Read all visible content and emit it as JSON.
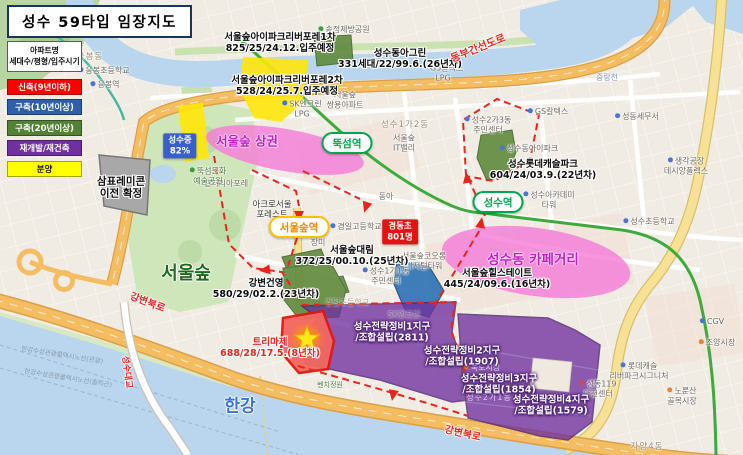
{
  "title": "성수 59타입 임장지도",
  "legend": {
    "header": [
      "아파트명",
      "세대수/평형/입주시기"
    ],
    "items": [
      {
        "label": "신축(9년이하)",
        "color": "#ff0000",
        "text": "#ffffff"
      },
      {
        "label": "구축(10년이상)",
        "color": "#2e5fa8",
        "text": "#ffffff"
      },
      {
        "label": "구축(20년이상)",
        "color": "#538135",
        "text": "#ffffff"
      },
      {
        "label": "재개발/재건축",
        "color": "#7030a0",
        "text": "#ffffff"
      },
      {
        "label": "분양",
        "color": "#ffff00",
        "text": "#1a1a1a"
      }
    ]
  },
  "stations": [
    {
      "id": "ttukseom-station",
      "name": "뚝섬역",
      "x": 347,
      "y": 143,
      "style": "green"
    },
    {
      "id": "seongsu-station",
      "name": "성수역",
      "x": 498,
      "y": 202,
      "style": "green"
    },
    {
      "id": "seoulsup-station",
      "name": "서울숲역",
      "x": 299,
      "y": 227,
      "style": "yellow"
    }
  ],
  "areas": [
    {
      "id": "seoulsup-commercial",
      "label": "서울숲 상권",
      "x": 247,
      "y": 140,
      "size": 12.5
    },
    {
      "id": "seongsu-cafe-street",
      "label": "성수동 카페거리",
      "x": 533,
      "y": 258,
      "size": 13.5
    }
  ],
  "badges": [
    {
      "id": "seongsu-middle-rate",
      "lines": [
        "성수중",
        "82%"
      ],
      "x": 180,
      "y": 146,
      "bg": "#3b5fc8"
    },
    {
      "id": "kyungdong-elem-size",
      "lines": [
        "경동초",
        "801명"
      ],
      "x": 400,
      "y": 232,
      "bg": "#e11414"
    }
  ],
  "apartments": [
    {
      "lines": [
        "서울숲아이파크리버포레1차",
        "825/25/24.12.입주예정"
      ],
      "x": 280,
      "y": 43,
      "cls": ""
    },
    {
      "lines": [
        "서울숲아이파크리버포레2차",
        "528/24/25.7.입주예정"
      ],
      "x": 287,
      "y": 86,
      "cls": ""
    },
    {
      "lines": [
        "성수동아그린",
        "331세대/22/99.6.(26년차)"
      ],
      "x": 400,
      "y": 59,
      "cls": ""
    },
    {
      "lines": [
        "성수롯데캐슬파크",
        "604/24/03.9.(22년차)"
      ],
      "x": 543,
      "y": 170,
      "cls": ""
    },
    {
      "lines": [
        "서울숲대림",
        "372/25/00.10.(25년차)"
      ],
      "x": 352,
      "y": 256,
      "cls": ""
    },
    {
      "lines": [
        "서울숲힐스테이트",
        "445/24/09.6.(16년차)"
      ],
      "x": 497,
      "y": 279,
      "cls": ""
    },
    {
      "lines": [
        "강변건영",
        "580/29/02.2.(23년차)"
      ],
      "x": 266,
      "y": 289,
      "cls": ""
    },
    {
      "lines": [
        "트리마제",
        "688/28/17.5.(8년차)"
      ],
      "x": 270,
      "y": 348,
      "cls": "red"
    },
    {
      "lines": [
        "삼표레미콘",
        "이전 확정"
      ],
      "x": 121,
      "y": 188,
      "cls": "big"
    }
  ],
  "zones": [
    {
      "lines": [
        "성수전략정비1지구",
        "/조합설립(2811)"
      ],
      "x": 392,
      "y": 333
    },
    {
      "lines": [
        "성수전략정비2지구",
        "/조합설립(1907)"
      ],
      "x": 462,
      "y": 357
    },
    {
      "lines": [
        "성수전략정비3지구",
        "/조합설립(1854)"
      ],
      "x": 499,
      "y": 385
    },
    {
      "lines": [
        "성수전략정비4지구",
        "/조합설립(1579)"
      ],
      "x": 551,
      "y": 406
    }
  ],
  "road_labels": [
    {
      "text": "동부간선도로",
      "x": 478,
      "y": 48,
      "rot": -22,
      "size": 10.5
    },
    {
      "text": "강변북로",
      "x": 148,
      "y": 301,
      "rot": 21,
      "size": 10
    },
    {
      "text": "강변북로",
      "x": 463,
      "y": 432,
      "rot": 13,
      "size": 10
    },
    {
      "text": "성수대교",
      "x": 128,
      "y": 372,
      "rot": 83,
      "size": 9
    }
  ],
  "big_labels": [
    {
      "text": "서울숲",
      "x": 186,
      "y": 272,
      "color": "#1e6b1e",
      "size": 18
    },
    {
      "text": "한강",
      "x": 240,
      "y": 404,
      "color": "#3a6fd8",
      "size": 17
    }
  ],
  "map_labels": [
    {
      "lines": [
        "응봉체육공원"
      ],
      "x": 167,
      "y": 32,
      "ico": "park"
    },
    {
      "lines": [
        "응봉동"
      ],
      "x": 90,
      "y": 57,
      "cls": "district"
    },
    {
      "lines": [
        "응봉초등학교"
      ],
      "x": 104,
      "y": 71,
      "ico": "school"
    },
    {
      "lines": [
        "응봉역"
      ],
      "x": 105,
      "y": 85,
      "ico": "rail"
    },
    {
      "lines": [
        "송정제방공원"
      ],
      "x": 344,
      "y": 30,
      "ico": "park"
    },
    {
      "lines": [
        "중랑천"
      ],
      "x": 607,
      "y": 78,
      "cls": "water"
    },
    {
      "lines": [
        "서울숲",
        "쌍용아파트"
      ],
      "x": 345,
      "y": 100
    },
    {
      "lines": [
        "SK엔크린",
        "LPG"
      ],
      "x": 302,
      "y": 109,
      "ico": "gas"
    },
    {
      "lines": [
        "GS칼텍스",
        "LPG"
      ],
      "x": 443,
      "y": 73,
      "ico": "gas"
    },
    {
      "lines": [
        "갤러리아포레"
      ],
      "x": 226,
      "y": 184
    },
    {
      "lines": [
        "뚝섬문화",
        "예술공원"
      ],
      "x": 208,
      "y": 176,
      "cls": "green",
      "ico": "park"
    },
    {
      "lines": [
        "성수1가2동"
      ],
      "x": 405,
      "y": 125,
      "cls": "district"
    },
    {
      "lines": [
        "서울숲",
        "IT밸리"
      ],
      "x": 404,
      "y": 143
    },
    {
      "lines": [
        "성수2가3동",
        "주민센터"
      ],
      "x": 488,
      "y": 125,
      "ico": "civic"
    },
    {
      "lines": [
        "성수동아이파크"
      ],
      "x": 529,
      "y": 149,
      "ico": "civic"
    },
    {
      "lines": [
        "GS칼텍스"
      ],
      "x": 548,
      "y": 112,
      "ico": "gas"
    },
    {
      "lines": [
        "성동세무서"
      ],
      "x": 637,
      "y": 117,
      "ico": "civic"
    },
    {
      "lines": [
        "생각공장",
        "데시앙플렉스"
      ],
      "x": 686,
      "y": 166,
      "ico": "civic"
    },
    {
      "lines": [
        "동아"
      ],
      "x": 386,
      "y": 197
    },
    {
      "lines": [
        "아크로서울",
        "포레스트"
      ],
      "x": 272,
      "y": 210,
      "cls": "strong"
    },
    {
      "lines": [
        "장미"
      ],
      "x": 318,
      "y": 243
    },
    {
      "lines": [
        "경일고등학교"
      ],
      "x": 356,
      "y": 227,
      "ico": "school"
    },
    {
      "lines": [
        "성수아카데미",
        "타워"
      ],
      "x": 549,
      "y": 200,
      "ico": "civic"
    },
    {
      "lines": [
        "성수초등학교"
      ],
      "x": 649,
      "y": 222,
      "ico": "school"
    },
    {
      "lines": [
        "서울숲코오롱",
        "디지털타워"
      ],
      "x": 424,
      "y": 261
    },
    {
      "lines": [
        "성수1가1동",
        "주민센터"
      ],
      "x": 386,
      "y": 276,
      "ico": "civic"
    },
    {
      "lines": [
        "경일초등학교"
      ],
      "x": 347,
      "y": 303,
      "cls": "dim"
    },
    {
      "lines": [
        "SK엔크린"
      ],
      "x": 404,
      "y": 315,
      "cls": "dim"
    },
    {
      "lines": [
        "뚝도시장"
      ],
      "x": 482,
      "y": 368,
      "cls": "onpurple",
      "ico": "market"
    },
    {
      "lines": [
        "성수2가1동"
      ],
      "x": 489,
      "y": 398,
      "cls": "district2"
    },
    {
      "lines": [
        "성동119",
        "안전센터"
      ],
      "x": 598,
      "y": 389,
      "ico": "fire"
    },
    {
      "lines": [
        "롯데캐슬",
        "리버파크시그니처"
      ],
      "x": 639,
      "y": 371,
      "ico": "civic"
    },
    {
      "lines": [
        "노룬산",
        "골목시장"
      ],
      "x": 682,
      "y": 396,
      "ico": "market"
    },
    {
      "lines": [
        "CGV"
      ],
      "x": 712,
      "y": 322,
      "ico": "cgv"
    },
    {
      "lines": [
        "조양시장"
      ],
      "x": 717,
      "y": 343,
      "ico": "market"
    },
    {
      "lines": [
        "자양4동"
      ],
      "x": 647,
      "y": 447,
      "cls": "district"
    },
    {
      "lines": [
        "벤치정원"
      ],
      "x": 330,
      "y": 385,
      "cls": "green tiny2"
    },
    {
      "lines": [
        "한강수상관광콜택시노선(관광)"
      ],
      "x": 62,
      "y": 356,
      "cls": "tiny",
      "rot": 9
    },
    {
      "lines": [
        "한강수상관광콜택시노선(출퇴근)"
      ],
      "x": 68,
      "y": 379,
      "cls": "tiny",
      "rot": 9
    }
  ]
}
